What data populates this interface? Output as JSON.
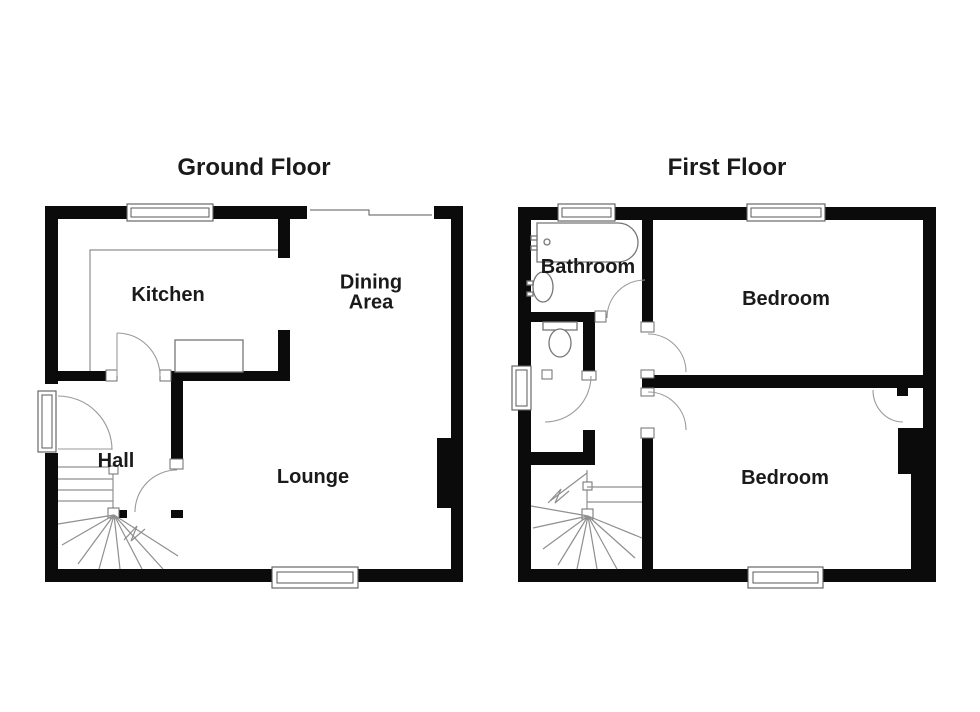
{
  "document_type": "floor-plan",
  "colors": {
    "wall": "#0b0b0b",
    "thin_line": "#8f8f8f",
    "door_arc": "#9a9a9a",
    "text": "#1a1a1a",
    "background": "#ffffff"
  },
  "floors": [
    {
      "title": "Ground Floor",
      "rooms": [
        {
          "name": "Kitchen"
        },
        {
          "name": "Dining Area"
        },
        {
          "name": "Hall"
        },
        {
          "name": "Lounge"
        }
      ]
    },
    {
      "title": "First Floor",
      "rooms": [
        {
          "name": "Bathroom"
        },
        {
          "name": "Bedroom"
        },
        {
          "name": "Bedroom"
        }
      ]
    }
  ]
}
